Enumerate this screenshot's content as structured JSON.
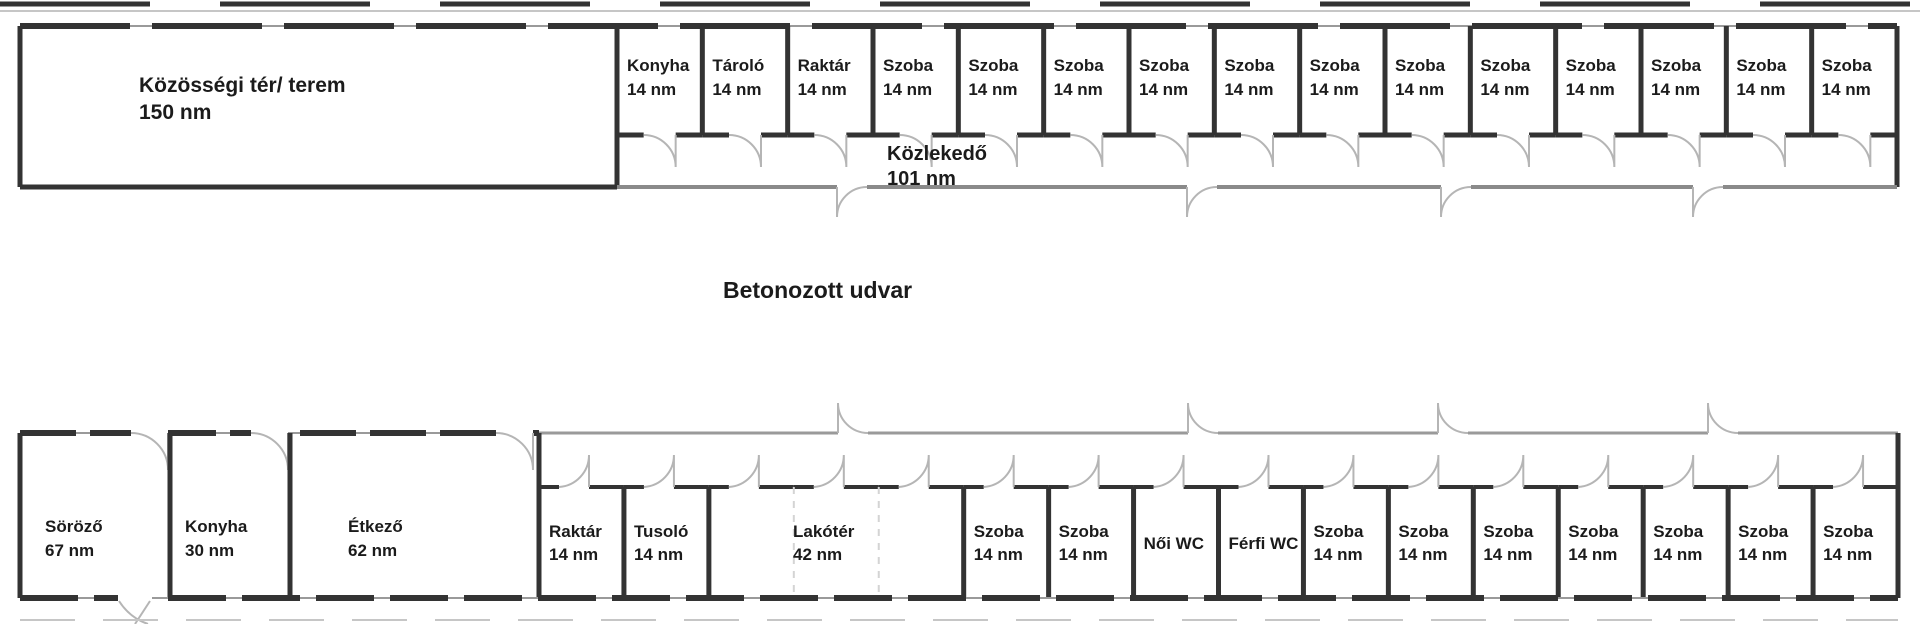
{
  "courtyard": {
    "label": "Betonozott udvar"
  },
  "top_building": {
    "hall": {
      "name": "Közösségi tér/ terem",
      "area": "150 nm"
    },
    "corridor": {
      "name": "Közlekedő",
      "area": "101 nm"
    },
    "rooms": [
      {
        "name": "Konyha",
        "area": "14 nm"
      },
      {
        "name": "Tároló",
        "area": "14 nm"
      },
      {
        "name": "Raktár",
        "area": "14 nm"
      },
      {
        "name": "Szoba",
        "area": "14 nm"
      },
      {
        "name": "Szoba",
        "area": "14 nm"
      },
      {
        "name": "Szoba",
        "area": "14 nm"
      },
      {
        "name": "Szoba",
        "area": "14 nm"
      },
      {
        "name": "Szoba",
        "area": "14 nm"
      },
      {
        "name": "Szoba",
        "area": "14 nm"
      },
      {
        "name": "Szoba",
        "area": "14 nm"
      },
      {
        "name": "Szoba",
        "area": "14 nm"
      },
      {
        "name": "Szoba",
        "area": "14 nm"
      },
      {
        "name": "Szoba",
        "area": "14 nm"
      },
      {
        "name": "Szoba",
        "area": "14 nm"
      },
      {
        "name": "Szoba",
        "area": "14 nm"
      }
    ]
  },
  "bottom_building": {
    "tall_rooms": [
      {
        "name": "Söröző",
        "area": "67 nm"
      },
      {
        "name": "Konyha",
        "area": "30 nm"
      },
      {
        "name": "Étkező",
        "area": "62 nm"
      }
    ],
    "rooms": [
      {
        "name": "Raktár",
        "area": "14 nm",
        "span": 1
      },
      {
        "name": "Tusoló",
        "area": "14 nm",
        "span": 1
      },
      {
        "name": "Lakótér",
        "area": "42 nm",
        "span": 3
      },
      {
        "name": "Szoba",
        "area": "14 nm",
        "span": 1
      },
      {
        "name": "Szoba",
        "area": "14 nm",
        "span": 1
      },
      {
        "name": "Női WC",
        "area": "",
        "span": 1
      },
      {
        "name": "Férfi WC",
        "area": "",
        "span": 1
      },
      {
        "name": "Szoba",
        "area": "14 nm",
        "span": 1
      },
      {
        "name": "Szoba",
        "area": "14 nm",
        "span": 1
      },
      {
        "name": "Szoba",
        "area": "14 nm",
        "span": 1
      },
      {
        "name": "Szoba",
        "area": "14 nm",
        "span": 1
      },
      {
        "name": "Szoba",
        "area": "14 nm",
        "span": 1
      },
      {
        "name": "Szoba",
        "area": "14 nm",
        "span": 1
      },
      {
        "name": "Szoba",
        "area": "14 nm",
        "span": 1
      }
    ]
  },
  "colors": {
    "wall": "#333333",
    "thin_wall": "#9a9a9a",
    "corridor_wall": "#8a8a8a",
    "door_arc": "#b5b5b5",
    "ghost_wall": "#d4d4d4",
    "fence": "#c6c6c6",
    "text": "#1b1b1b",
    "background": "#ffffff"
  }
}
